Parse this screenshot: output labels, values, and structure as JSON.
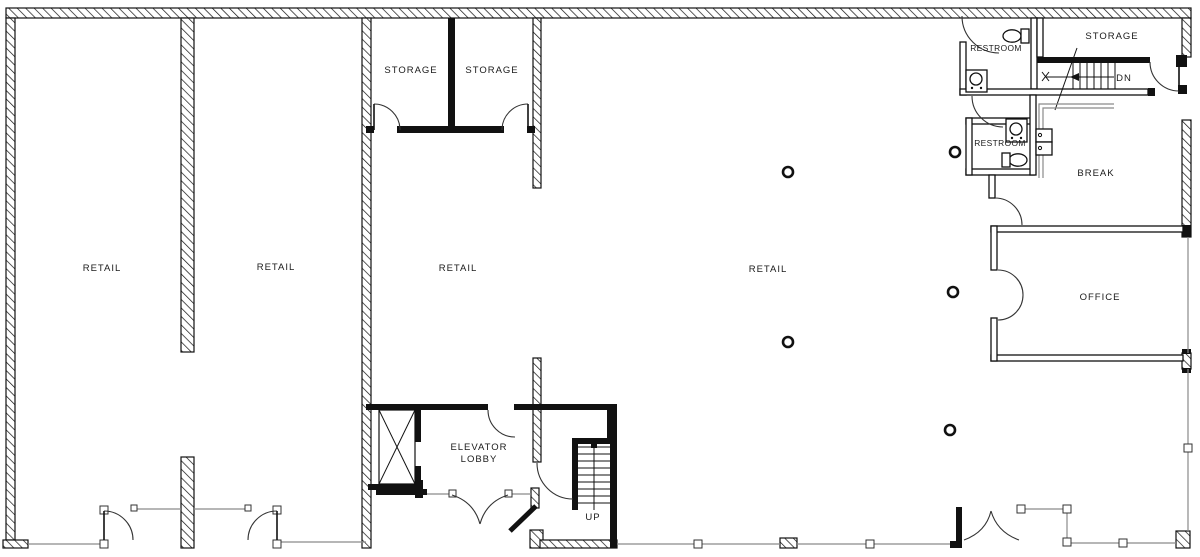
{
  "plan": {
    "type": "architectural-floor-plan",
    "floor": "ground-floor-retail-building",
    "colors": {
      "wall": "#111111",
      "glazing": "#8a8a8a",
      "door_arc": "#333333",
      "background": "#ffffff"
    },
    "floor_labels": {
      "retail_1": "RETAIL",
      "retail_2": "RETAIL",
      "retail_3": "RETAIL",
      "retail_4": "RETAIL",
      "storage_1": "STORAGE",
      "storage_2": "STORAGE",
      "storage_3": "STORAGE",
      "restroom_1": "RESTROOM",
      "restroom_2": "RESTROOM",
      "break_room": "BREAK",
      "office": "OFFICE",
      "elevator_lobby_line_1": "ELEVATOR",
      "elevator_lobby_line_2": "LOBBY",
      "stair_up": "UP",
      "stair_down": "DN"
    },
    "fixtures": [
      "toilet-icon",
      "toilet-icon",
      "sink-icon",
      "sink-icon",
      "kitchen-counter",
      "appliance-icon",
      "elevator-cab-icon"
    ],
    "columns_count": 5,
    "entry_doors_count": 6
  }
}
